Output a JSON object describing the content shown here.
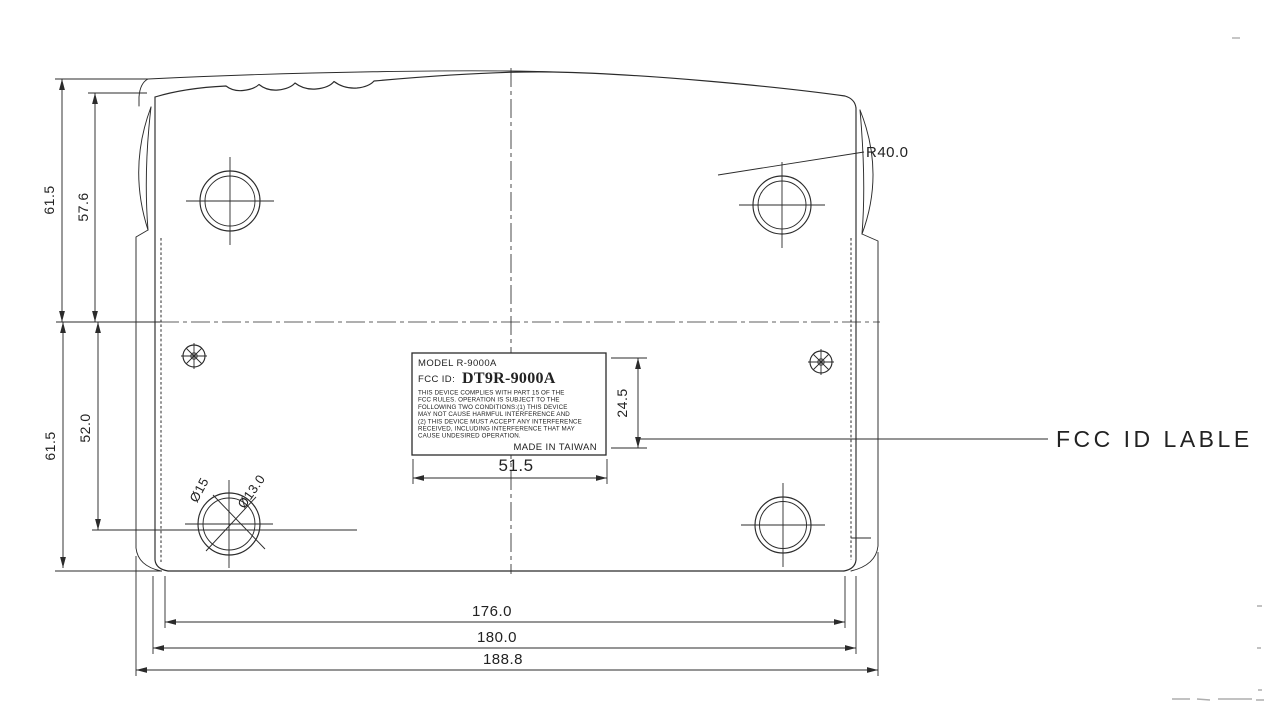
{
  "drawing": {
    "callouts": {
      "fcc_label_callout": "FCC ID LABLE",
      "corner_radius": "R40.0",
      "foot_outer_diameter": "Ø15",
      "foot_inner_diameter": "Ø13.0"
    },
    "dimensions": {
      "upper_half_height_outer": "61.5",
      "upper_half_height_inner": "57.6",
      "lower_half_height_outer": "61.5",
      "lower_half_height_inner": "52.0",
      "label_width": "51.5",
      "label_height": "24.5",
      "width_inner": "176.0",
      "width_mid": "180.0",
      "width_outer": "188.8"
    },
    "label": {
      "model_line": "MODEL   R-9000A",
      "fcc_id_prefix": "FCC ID:",
      "fcc_id_value": "DT9R-9000A",
      "compliance_lines": [
        "THIS DEVICE COMPLIES WITH PART 15 OF THE",
        "FCC RULES. OPERATION IS SUBJECT TO THE",
        "FOLLOWING TWO CONDITIONS:(1) THIS DEVICE",
        "MAY NOT CAUSE HARMFUL INTERFERENCE AND",
        "(2) THIS DEVICE MUST ACCEPT ANY INTERFERENCE",
        "RECEIVED, INCLUDING INTERFERENCE THAT MAY",
        "CAUSE UNDESIRED OPERATION."
      ],
      "origin_line": "MADE IN TAIWAN"
    }
  }
}
